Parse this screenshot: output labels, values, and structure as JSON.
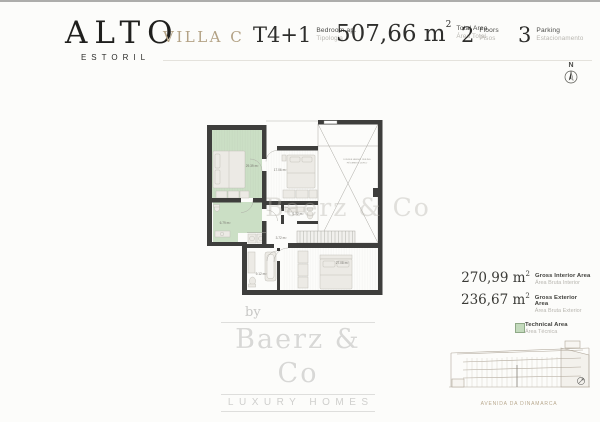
{
  "brand": {
    "name": "ALTO",
    "subtitle": "ESTORIL"
  },
  "header": {
    "villa_name": "VILLA C",
    "specs": [
      {
        "value": "T4+1",
        "superscript": "",
        "label_primary": "Bedroom ap.",
        "label_secondary": "Tipologia"
      },
      {
        "value": "507,66 m",
        "superscript": "2",
        "label_primary": "Total Area",
        "label_secondary": "Área Total"
      },
      {
        "value": "2",
        "superscript": "",
        "label_primary": "Floors",
        "label_secondary": "Pisos"
      },
      {
        "value": "3",
        "superscript": "",
        "label_primary": "Parking",
        "label_secondary": "Estacionamento"
      }
    ]
  },
  "compass": {
    "north_label": "N"
  },
  "floor_plan": {
    "watermark": "Baerz & Co",
    "room_labels": {
      "bedroom_main": "29.39 m²",
      "bedroom_middle": "17.06 m²",
      "wc": "1.72 m²",
      "hall": "3.72 m²",
      "bathroom": "9.12 m²",
      "bedroom_lower": "27.08 m²",
      "bathroom_green": "6.79 m²"
    },
    "void_label": {
      "line1": "DOUBLE HEIGHT CEILING",
      "line2": "PÉ DIREITO DUPLO"
    },
    "colors": {
      "wall": "#3e3e3c",
      "technical_green": "#cbdfc5"
    }
  },
  "areas_panel": {
    "rows": [
      {
        "value": "270,99 m",
        "superscript": "2",
        "label_primary": "Gross Interior Area",
        "label_secondary": "Área Bruta Interior"
      },
      {
        "value": "236,67 m",
        "superscript": "2",
        "label_primary": "Gross Exterior Area",
        "label_secondary": "Área Bruta Exterior"
      }
    ],
    "legend": {
      "swatch_color": "#c3dabc",
      "label_primary": "Technical Area",
      "label_secondary": "Área Técnica"
    }
  },
  "elevation": {
    "caption": "AVENIDA DA DINAMARCA"
  },
  "footer_logo": {
    "prefix": "by",
    "name": "Baerz & Co",
    "tagline": "LUXURY HOMES"
  }
}
